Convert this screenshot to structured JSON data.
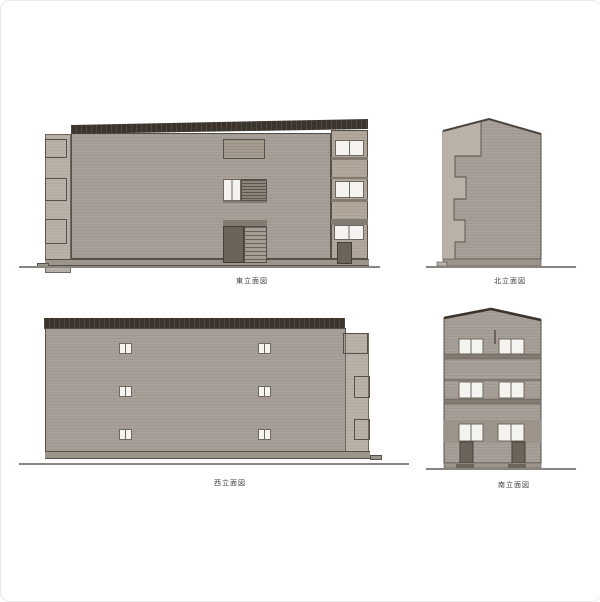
{
  "sheet": {
    "description_hidden": null
  },
  "drawings": {
    "east": {
      "label": "東立面図"
    },
    "north": {
      "label": "北立面図"
    },
    "west": {
      "label": "西立面図"
    },
    "south": {
      "label": "南立面図"
    }
  },
  "colors": {
    "sheet_bg": "#ffffff",
    "wall": "#a8a098",
    "wall_light": "#bab2a9",
    "wall_tan": "#b2a89c",
    "roof": "#3b342d",
    "line": "#55504a",
    "frame": "#6e6861",
    "window": "#f4f3f0",
    "door": "#6b645a",
    "louver": "#8d8579",
    "panel": "#a59c8f",
    "stair": "#a69e94",
    "slab": "#837b71",
    "band": "#9c948b",
    "base": "#9c958c",
    "ground": "#8a8580",
    "label": "#3c3c3c"
  }
}
